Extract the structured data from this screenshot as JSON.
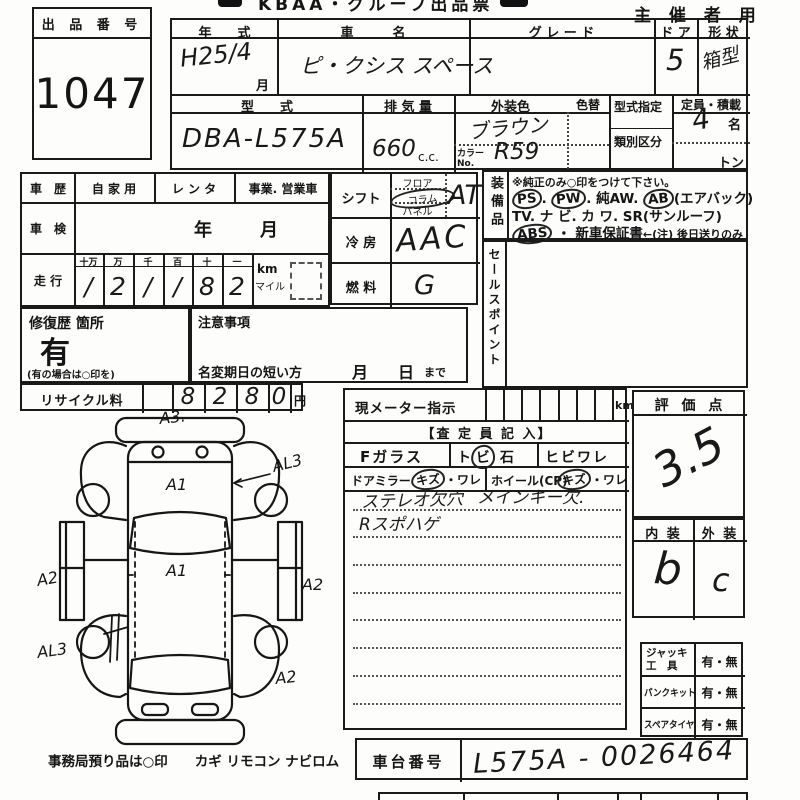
{
  "header": {
    "strip": "KBAA・グループ出品票",
    "organizer": "主 催 者 用"
  },
  "lot": {
    "label": "出 品 番 号",
    "number": "1047"
  },
  "vehicle": {
    "year_label": "年　　式",
    "year_value": "H25/4",
    "month_suffix": "月",
    "name_label": "車　　　名",
    "name_value": "ピ・クシス スペース",
    "grade_label": "グ レ ー ド",
    "grade_value": "",
    "door_label": "ド ア",
    "door_value": "5",
    "shape_label": "形 状",
    "shape_value": "箱型",
    "model_label": "型　　式",
    "model_value": "DBA-L575A",
    "disp_label": "排 気 量",
    "disp_value": "660",
    "disp_unit": "c.c.",
    "color_label": "外装色",
    "color_value": "ブラウン",
    "color_no_label": "カラーNo.",
    "color_no_value": "R59",
    "color_change_label": "色替",
    "model_desig_label": "型式指定",
    "class_label": "類別区分",
    "capacity_label": "定員・積載",
    "capacity_value": "4",
    "capacity_unit": "名",
    "load_unit": "トン"
  },
  "history": {
    "label": "車　歴",
    "opt1": "自 家 用",
    "opt2": "レ ン タ",
    "opt3": "事業. 営業車"
  },
  "inspection": {
    "label": "車　検",
    "year": "年",
    "month": "月"
  },
  "mileage": {
    "label": "走 行",
    "columns": [
      "十万",
      "万",
      "千",
      "百",
      "十",
      "一"
    ],
    "digits": [
      "/",
      "2",
      "/",
      "/",
      "8",
      "2"
    ],
    "unit_km": "km",
    "unit_mile": "マイル"
  },
  "shift": {
    "label": "シフト",
    "options": [
      {
        "text": "フロア",
        "circled": false
      },
      {
        "text": "コラム",
        "circled": true
      },
      {
        "text": "パネル",
        "circled": false
      }
    ],
    "value": "AT"
  },
  "cooling": {
    "label": "冷 房",
    "value": "AAC"
  },
  "fuel": {
    "label": "燃 料",
    "value": "G"
  },
  "equipment": {
    "label": "装備品",
    "note": "※純正のみ○印をつけて下さい。",
    "lines": [
      [
        {
          "text": "PS",
          "circled": true
        },
        {
          "text": ". ",
          "circled": false
        },
        {
          "text": "PW",
          "circled": true
        },
        {
          "text": ".  純AW.  ",
          "circled": false
        },
        {
          "text": "AB",
          "circled": true
        },
        {
          "text": "(エアバック)",
          "circled": false
        }
      ],
      [
        {
          "text": "TV.  ナ ビ.  カ ワ.  SR(サンルーフ)",
          "circled": false
        }
      ],
      [
        {
          "text": "ABS",
          "circled": true
        },
        {
          "text": " ・ 新車保証書",
          "circled": false
        },
        {
          "text": "←(注) 後日送りのみ",
          "circled": false,
          "small": true
        }
      ]
    ]
  },
  "sales_point": {
    "label": "セールスポイント"
  },
  "repair": {
    "label": "修復歴 箇所",
    "value": "有",
    "note": "(有の場合は○印を)"
  },
  "caution": {
    "label": "注意事項"
  },
  "name_change": {
    "label": "名変期日の短い方",
    "month": "月",
    "day": "日",
    "until": "まで"
  },
  "recycle": {
    "label": "リサイクル料",
    "digits": [
      "8",
      "2",
      "8",
      "0"
    ],
    "unit": "円"
  },
  "meter": {
    "label": "現メーター指示",
    "unit": "km"
  },
  "assessor": {
    "title": "【査 定 員 記 入】",
    "f_glass": "Fガラス",
    "stone_prefix": "ト",
    "stone_circled": "ビ",
    "stone_suffix": "石",
    "crack": "ヒビワレ",
    "door_mirror": "ドアミラー",
    "scratch1_circled": "キズ",
    "scratch1_rest": "・ワレ",
    "wheel": "ホイール(CP)",
    "scratch2_circled": "キズ",
    "scratch2_rest": "・ワレ",
    "note_line1a": "ステレオ欠穴",
    "note_line1b": "メインキー欠.",
    "note_line2": "Rスポハゲ"
  },
  "evaluation": {
    "label": "評 価 点",
    "score": "3.5"
  },
  "interior_exterior": {
    "interior_label": "内 装",
    "exterior_label": "外 装",
    "interior_value": "b",
    "exterior_value": "c"
  },
  "accessories": {
    "rows": [
      {
        "label": "ジャッキ\n工　具",
        "value": "有・無"
      },
      {
        "label": "パンクキット",
        "value": "有・無"
      },
      {
        "label": "スペアタイヤ",
        "value": "有・無"
      }
    ]
  },
  "chassis": {
    "label": "車台番号",
    "value": "L575A - 0026464"
  },
  "footer": {
    "note": "事務局預り品は○印　　カギ  リモコン  ナビロム"
  },
  "diagram": {
    "annotations": {
      "a3": "A3.",
      "al3_top": "AL3",
      "a1_hood": "A1",
      "a1_roof": "A1",
      "a2_left": "A2",
      "a2_right": "A2",
      "al3_bottom": "AL3",
      "a2_bottom": "A2"
    }
  }
}
